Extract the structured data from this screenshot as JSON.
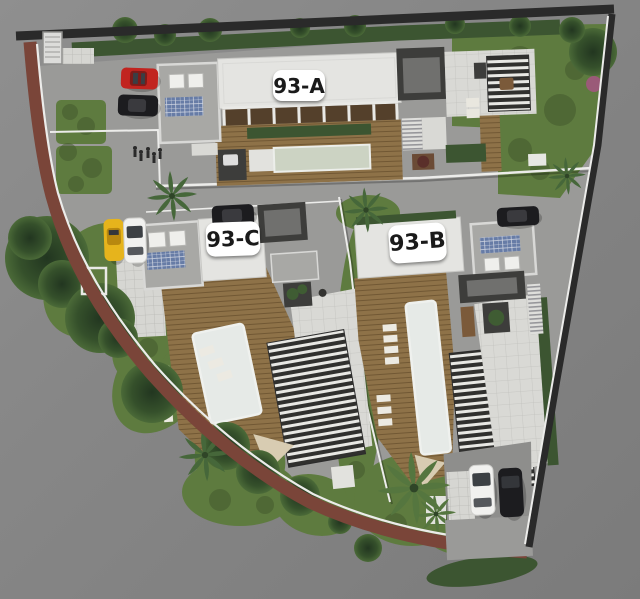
{
  "units": [
    {
      "id": "93-A",
      "label": "93-A"
    },
    {
      "id": "93-C",
      "label": "93-C"
    },
    {
      "id": "93-B",
      "label": "93-B"
    }
  ],
  "site": {
    "cars": [
      {
        "name": "car-red-parked-top-left",
        "color_key": "car_red"
      },
      {
        "name": "car-black-parked-top-left",
        "color_key": "car_black"
      },
      {
        "name": "car-yellow-parked-left",
        "color_key": "car_yellow"
      },
      {
        "name": "car-white-parked-left",
        "color_key": "car_white"
      },
      {
        "name": "car-black-above-93c",
        "color_key": "car_black"
      },
      {
        "name": "car-black-above-93b",
        "color_key": "car_black"
      },
      {
        "name": "car-white-bottom-right",
        "color_key": "car_white"
      },
      {
        "name": "car-black-bottom-right",
        "color_key": "car_black"
      }
    ]
  },
  "colors": {
    "road": "#848484",
    "lot_paving": "#9a9a98",
    "tile": "#d6d6d2",
    "grass": "#5e7b3f",
    "grass_dark": "#44592d",
    "hedge": "#3c5531",
    "deck": "#8e7248",
    "roof_white": "#e4e4e1",
    "roof_gray": "#a8a8a5",
    "core_dark": "#3d3d3b",
    "core_panel": "#70706e",
    "terrace": "#d9d9d5",
    "sidewalk_brick": "#7a4539",
    "wall_white": "#ececea",
    "wall_dark": "#2a2a2a",
    "pool_main": "#ccd3c3",
    "pool_white": "#e6eae7",
    "solar": "#677ca6",
    "slat_dark": "#30302e",
    "sail": "#d8ccb2",
    "badge_bg": "#ffffff",
    "badge_text": "#1a1a1a",
    "car_red": "#c1241f",
    "car_yellow": "#e6b41c",
    "car_black": "#1c1c1f",
    "car_white": "#f1f1ef"
  }
}
